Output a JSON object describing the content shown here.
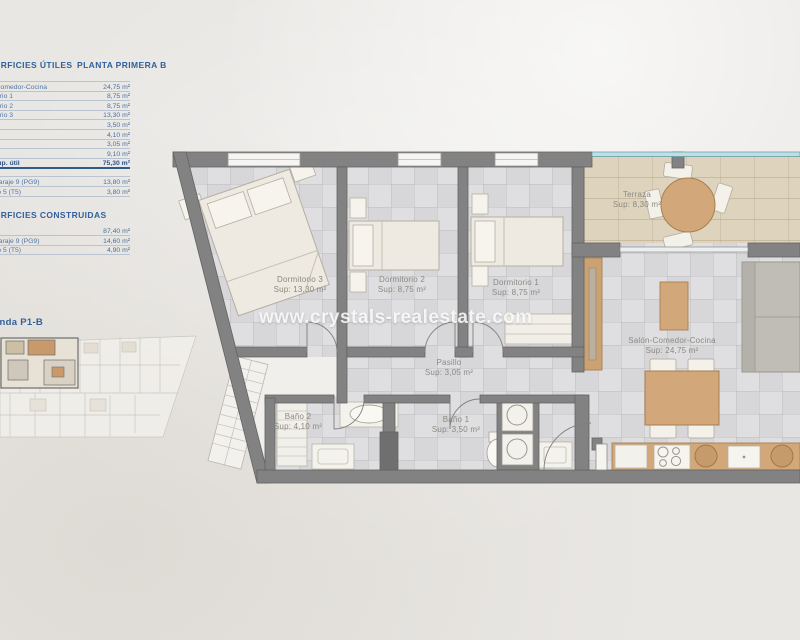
{
  "watermark": "www.crystals-realestate.com",
  "sidebar": {
    "utiles_title": "SUPERFICIES ÚTILES",
    "planta_title": "PLANTA PRIMERA B",
    "utiles_rows": [
      {
        "label": "Salón-Comedor-Cocina",
        "value": "24,75 m²"
      },
      {
        "label": "Dormitorio 1",
        "value": "8,75 m²"
      },
      {
        "label": "Dormitorio 2",
        "value": "8,75 m²"
      },
      {
        "label": "Dormitorio 3",
        "value": "13,30 m²"
      },
      {
        "label": "Baño 1",
        "value": "3,50 m²"
      },
      {
        "label": "Baño 2",
        "value": "4,10 m²"
      },
      {
        "label": "Pasillo",
        "value": "3,05 m²"
      },
      {
        "label": "Terraza",
        "value": "9,10 m²"
      }
    ],
    "utiles_total": {
      "label": "Total sup. útil",
      "value": "75,30 m²"
    },
    "anexos_rows": [
      {
        "label": "Plaza garaje 9 (PG9)",
        "value": "13,80 m²"
      },
      {
        "label": "Trastero 5 (T5)",
        "value": "3,80 m²"
      }
    ],
    "construidas_title": "SUPERFICIES CONSTRUIDAS",
    "construidas_rows": [
      {
        "label": "",
        "value": "87,40 m²"
      },
      {
        "label": "Plaza garaje 9 (PG9)",
        "value": "14,60 m²"
      },
      {
        "label": "Trastero 5 (T5)",
        "value": "4,90 m²"
      }
    ],
    "keyplan_label": "Vivienda P1-B"
  },
  "plan": {
    "rooms": {
      "dormitorio3": {
        "name": "Dormitorio 3",
        "sup": "Sup: 13,30 m²"
      },
      "dormitorio2": {
        "name": "Dormitorio 2",
        "sup": "Sup: 8,75 m²"
      },
      "dormitorio1": {
        "name": "Dormitorio 1",
        "sup": "Sup: 8,75 m²"
      },
      "terraza": {
        "name": "Terraza",
        "sup": "Sup: 8,30 m²"
      },
      "salon": {
        "name": "Salón-Comedor-Cocina",
        "sup": "Sup: 24,75 m²"
      },
      "pasillo": {
        "name": "Pasillo",
        "sup": "Sup: 3,05 m²"
      },
      "bano2": {
        "name": "Baño 2",
        "sup": "Sup: 4,10 m²"
      },
      "bano1": {
        "name": "Baño 1",
        "sup": "Sup: 3,50 m²"
      }
    }
  },
  "colors": {
    "table_text": "#3f6b9f",
    "wall": "#828282",
    "wood": "#d2a77a",
    "terrace_floor": "#ded3bd",
    "glass_rail": "#bfdfe3",
    "floor_tile": "#dadadd"
  }
}
